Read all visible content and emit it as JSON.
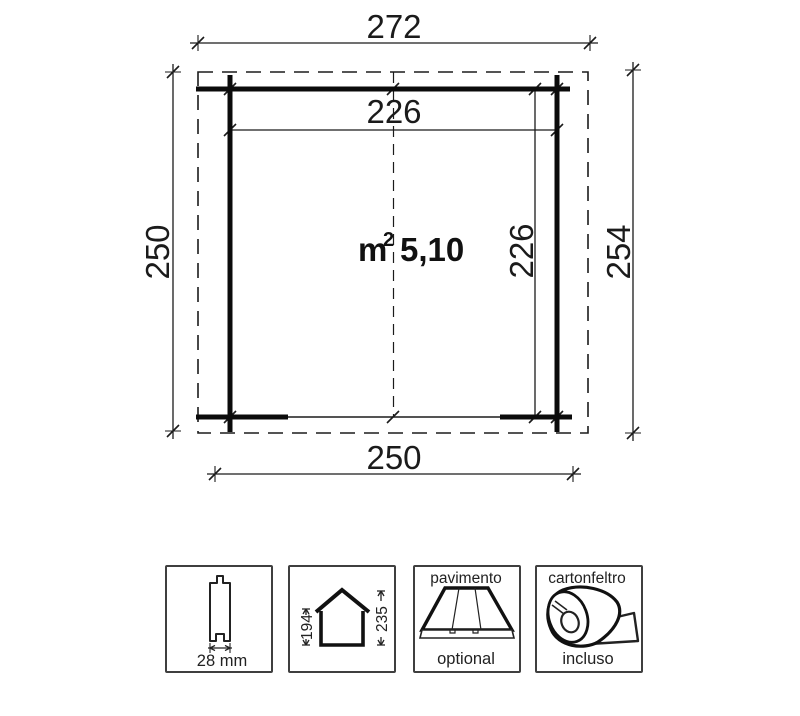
{
  "plan": {
    "dims": {
      "roof_width": "272",
      "inner_width": "226",
      "left_height": "250",
      "right_height": "254",
      "inner_height": "226",
      "bottom_width": "250"
    },
    "area": {
      "unit": "m",
      "superscript": "2",
      "value": "5,10"
    }
  },
  "legend": {
    "plank": {
      "icon": "plank-profile-icon",
      "label": "28 mm"
    },
    "house": {
      "icon": "house-gable-icon",
      "wall_height": "194",
      "ridge_height": "235"
    },
    "floor": {
      "icon": "floor-boards-icon",
      "title": "pavimento",
      "status": "optional"
    },
    "felt": {
      "icon": "felt-roll-icon",
      "title": "cartonfeltro",
      "status": "incluso"
    }
  },
  "colors": {
    "line": "#1b1b1b",
    "wall": "#0b0b0b",
    "background": "#ffffff"
  }
}
